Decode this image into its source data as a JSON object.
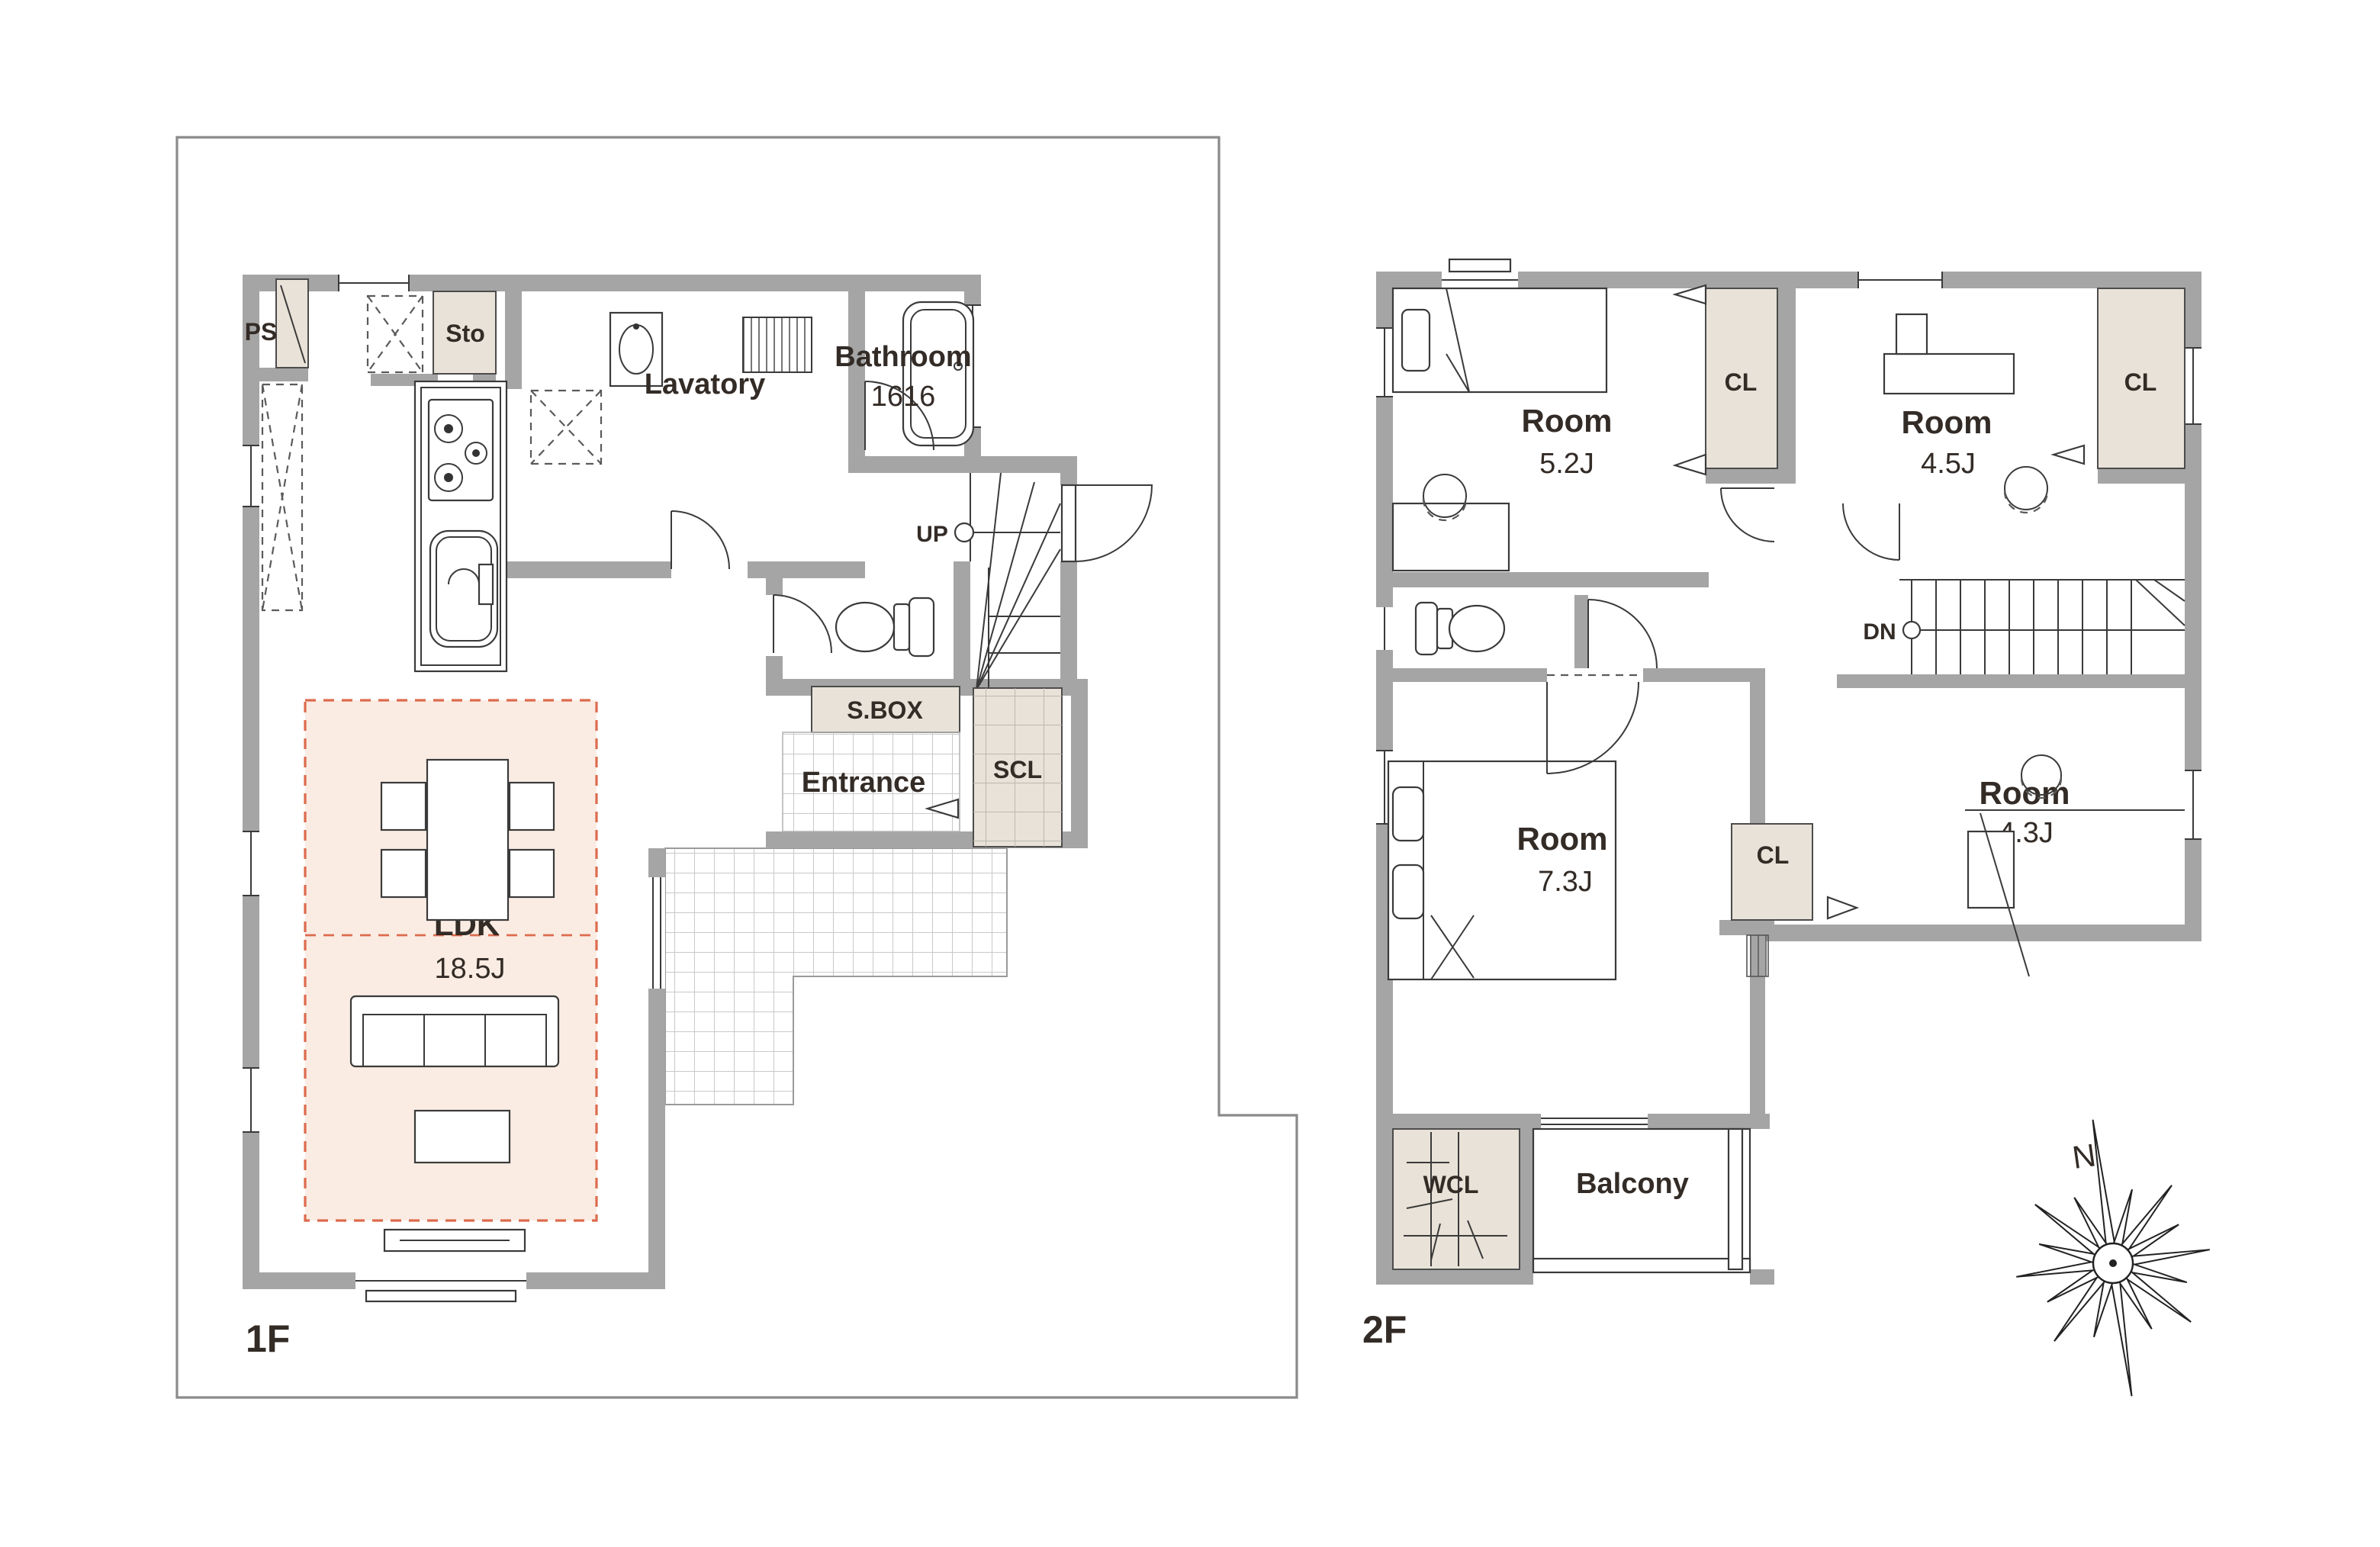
{
  "floor1": {
    "label": "1F",
    "rooms": {
      "ps": "PS",
      "sto": "Sto",
      "lavatory": "Lavatory",
      "bathroom_name": "Bathroom",
      "bathroom_size": "1616",
      "up": "UP",
      "shoe_box": "S.BOX",
      "entrance": "Entrance",
      "scl": "SCL",
      "ldk_name": "LDK",
      "ldk_size": "18.5J"
    }
  },
  "floor2": {
    "label": "2F",
    "rooms": {
      "room1_name": "Room",
      "room1_size": "5.2J",
      "room2_name": "Room",
      "room2_size": "4.5J",
      "room3_name": "Room",
      "room3_size": "7.3J",
      "room4_name": "Room",
      "room4_size": "4.3J",
      "cl1": "CL",
      "cl2": "CL",
      "cl3": "CL",
      "wcl": "WCL",
      "balcony": "Balcony",
      "dn": "DN"
    }
  },
  "compass": {
    "north_label": "N"
  },
  "colors": {
    "wall": "#a5a5a5",
    "closet_fill": "#e9e2d8",
    "ldk_highlight_fill": "#faece3",
    "ldk_highlight_border": "#dd6b4d",
    "line": "#3a3a3a",
    "text": "#332b26",
    "site_boundary": "#8a8a8a",
    "tile_line": "#c9c9c9"
  }
}
